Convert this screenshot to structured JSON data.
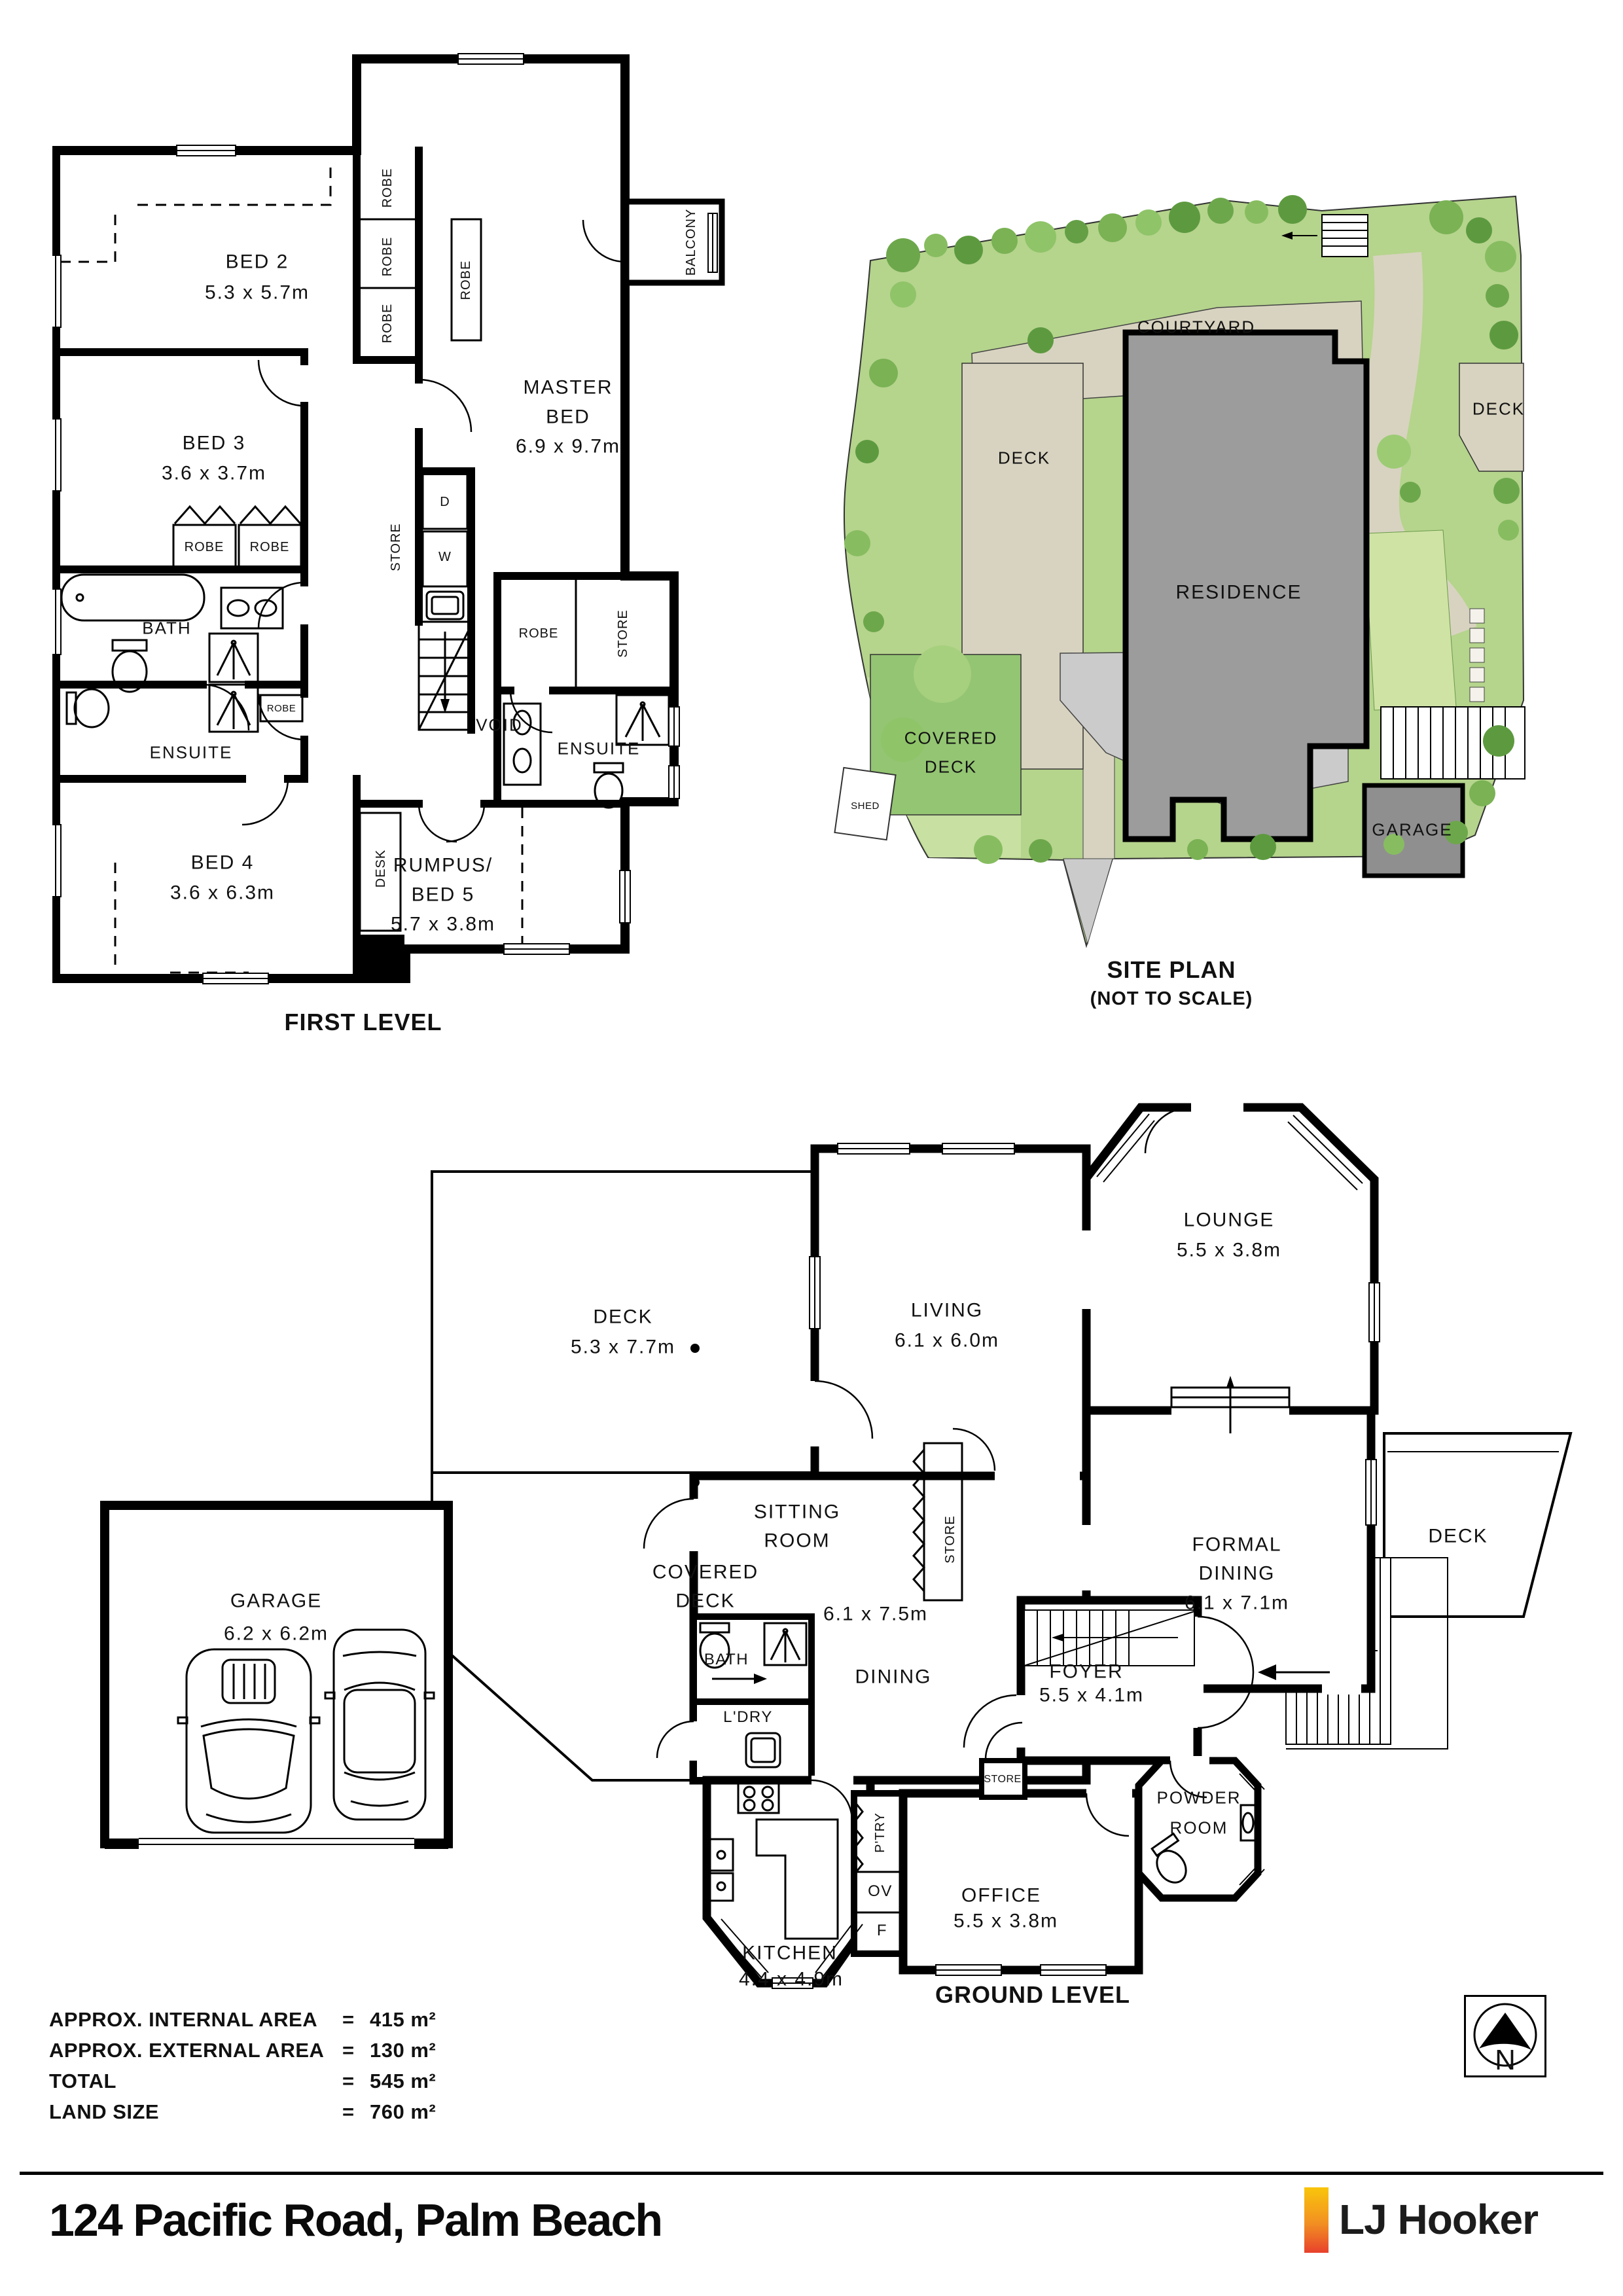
{
  "first_level": {
    "caption": "FIRST LEVEL",
    "bed2": {
      "name": "BED 2",
      "dims": "5.3 x 5.7m"
    },
    "bed3": {
      "name": "BED 3",
      "dims": "3.6 x 3.7m"
    },
    "master": {
      "line1": "MASTER",
      "line2": "BED",
      "dims": "6.9 x 9.7m"
    },
    "bed4": {
      "name": "BED 4",
      "dims": "3.6 x 6.3m"
    },
    "rumpus": {
      "line1": "RUMPUS/",
      "line2": "BED 5",
      "dims": "5.7 x 3.8m"
    },
    "bath": "BATH",
    "ensuite": "ENSUITE",
    "void": "VOID",
    "balcony": "BALCONY",
    "desk": "DESK",
    "robe": "ROBE",
    "store": "STORE",
    "dryer": "D",
    "washer": "W"
  },
  "site_plan": {
    "caption": "SITE PLAN",
    "caption_note": "(NOT TO SCALE)",
    "courtyard": "COURTYARD",
    "deck": "DECK",
    "residence": "RESIDENCE",
    "covered_deck_line1": "COVERED",
    "covered_deck_line2": "DECK",
    "garage": "GARAGE",
    "shed": "SHED"
  },
  "ground_level": {
    "caption": "GROUND LEVEL",
    "deck": {
      "name": "DECK",
      "dims": "5.3 x 7.7m"
    },
    "living": {
      "name": "LIVING",
      "dims": "6.1 x 6.0m"
    },
    "lounge": {
      "name": "LOUNGE",
      "dims": "5.5 x 3.8m"
    },
    "formal_dining": {
      "line1": "FORMAL",
      "line2": "DINING",
      "dims": "6.1 x 7.1m"
    },
    "deck_right": "DECK",
    "sitting": {
      "line1": "SITTING",
      "line2": "ROOM"
    },
    "dining": {
      "name": "DINING",
      "dims": "6.1 x 7.5m"
    },
    "covered_deck": {
      "line1": "COVERED",
      "line2": "DECK"
    },
    "bath": "BATH",
    "laundry": "L'DRY",
    "foyer": {
      "name": "FOYER",
      "dims": "5.5 x 4.1m"
    },
    "store": "STORE",
    "pantry": "P'TRY",
    "oven": "OV",
    "fridge": "F",
    "kitchen": {
      "name": "KITCHEN",
      "dims": "4.4 x 4.9m"
    },
    "office": {
      "name": "OFFICE",
      "dims": "5.5 x 3.8m"
    },
    "powder": {
      "line1": "POWDER",
      "line2": "ROOM"
    }
  },
  "garage_plan": {
    "name": "GARAGE",
    "dims": "6.2 x 6.2m"
  },
  "summary": {
    "rows": [
      {
        "label": "APPROX. INTERNAL AREA",
        "eq": "=",
        "value": "415 m²"
      },
      {
        "label": "APPROX. EXTERNAL AREA",
        "eq": "=",
        "value": "130 m²"
      },
      {
        "label": "TOTAL",
        "eq": "=",
        "value": "545 m²"
      },
      {
        "label": "LAND SIZE",
        "eq": "=",
        "value": "760 m²"
      }
    ]
  },
  "compass": {
    "north": "N"
  },
  "footer": {
    "address": "124 Pacific Road, Palm Beach",
    "brand": "LJ Hooker"
  },
  "colors": {
    "walls": "#000000",
    "grass": "#b5d48c",
    "path_beige": "#d8d3c0",
    "residence_grey": "#9c9c9c",
    "brand_bar_top": "#f9c50b",
    "brand_bar_mid": "#f29022",
    "brand_bar_bottom": "#e8412c"
  }
}
